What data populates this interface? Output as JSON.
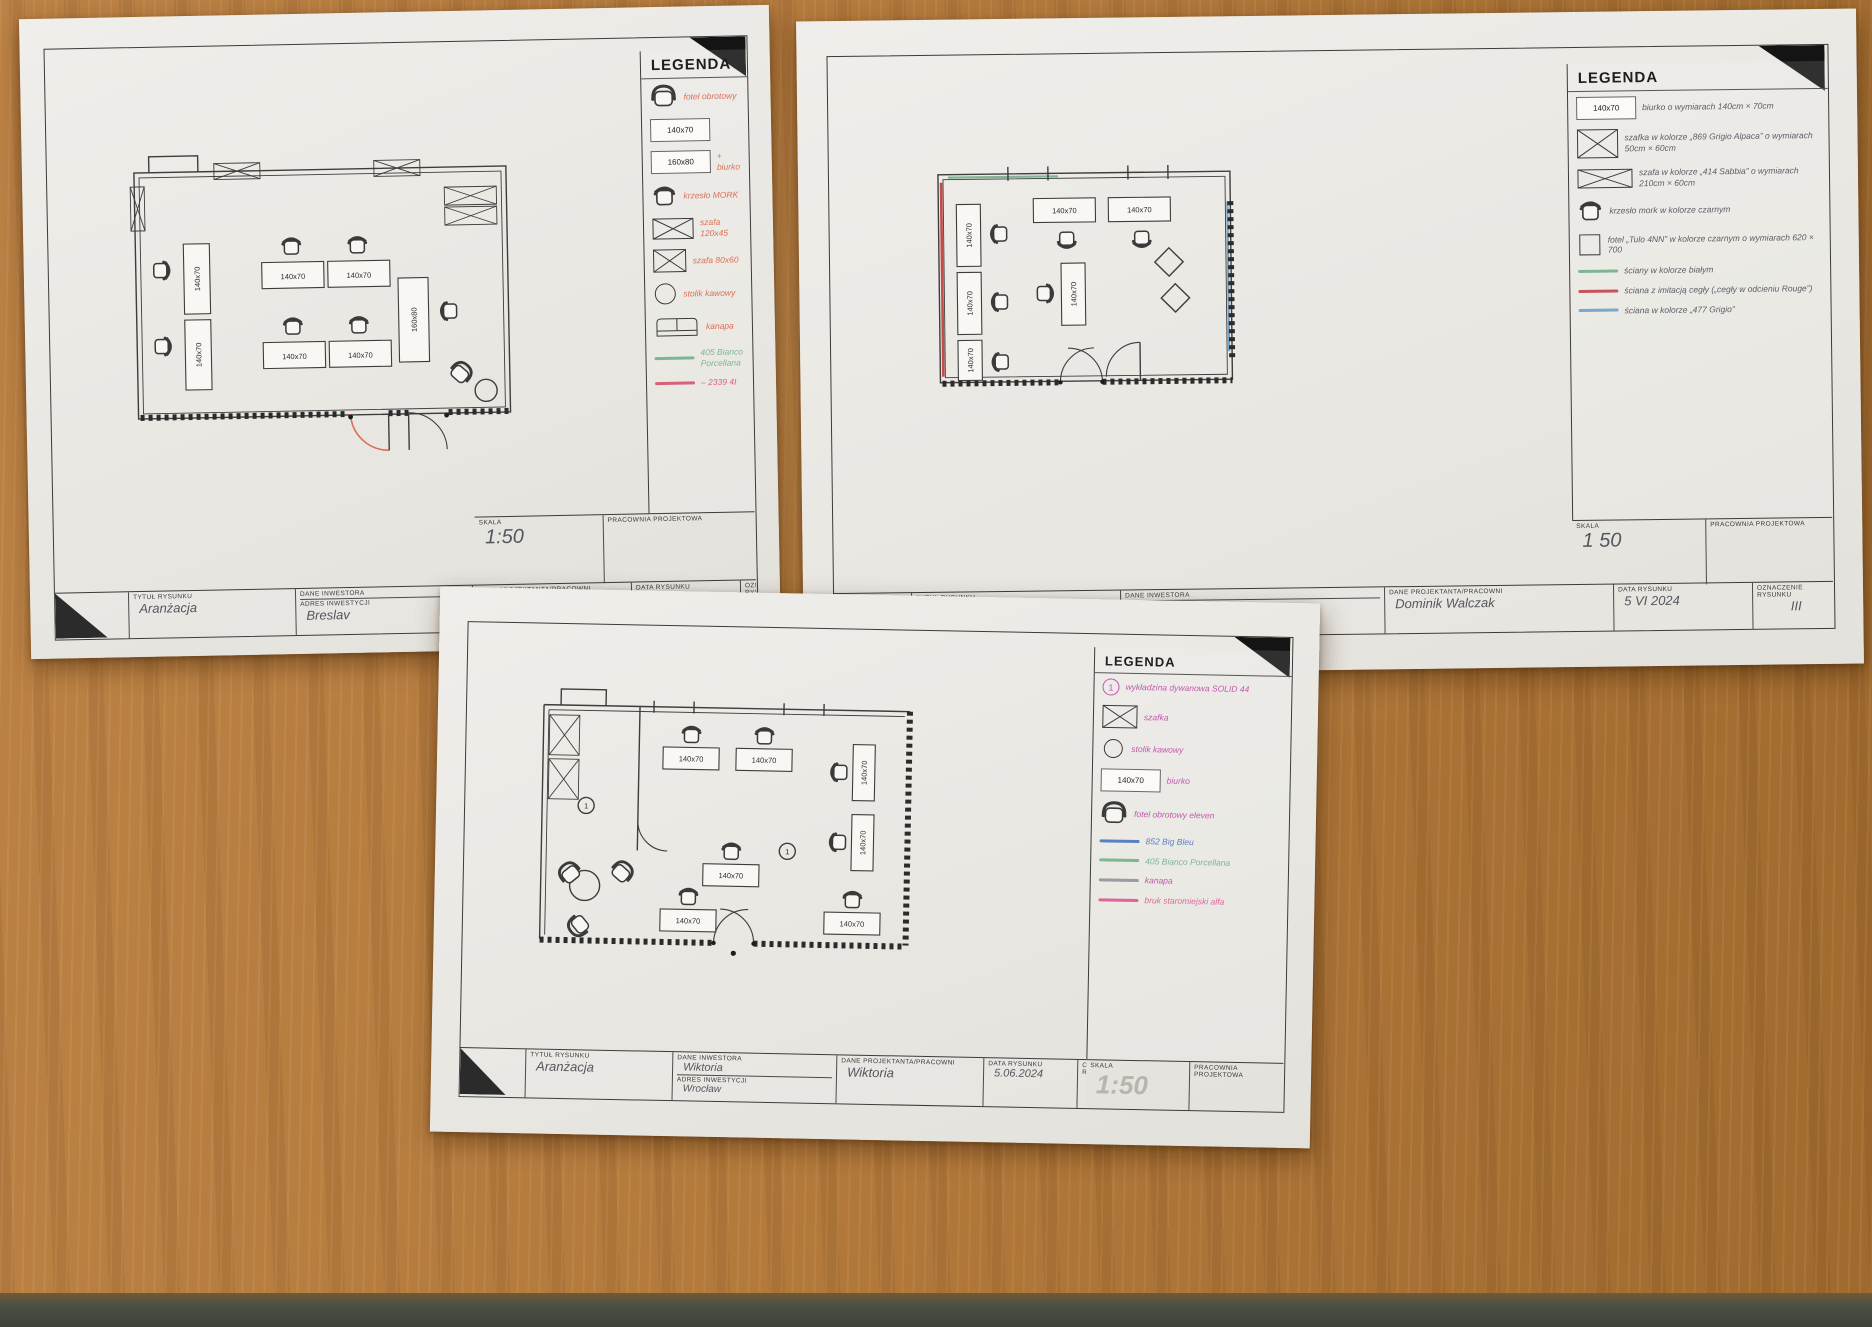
{
  "surface": {
    "description": "wooden desk top",
    "wood_color": "#b47a3c",
    "edge_color": "#4b4f45"
  },
  "sheets": [
    {
      "legend": {
        "title": "LEGENDA",
        "ink": "#dd6f55",
        "items": [
          {
            "icon": "armchair-top",
            "label": "fotel obrotowy"
          },
          {
            "icon": "desk-box",
            "value": "140x70"
          },
          {
            "icon": "desk-box",
            "value": "160x80",
            "note": "+ biurko"
          },
          {
            "icon": "chair-top",
            "label": "krzesło MORK"
          },
          {
            "icon": "crossed-box",
            "label": "szafa 120x45"
          },
          {
            "icon": "crossed-box",
            "label": "szafa 80x60"
          },
          {
            "icon": "circle",
            "label": "stolik kawowy"
          },
          {
            "icon": "sofa",
            "label": "kanapa"
          },
          {
            "icon": "color-line",
            "color": "#7eb694",
            "label": "405 Bianco Porcellana",
            "label_color": "#7eb694"
          },
          {
            "icon": "color-line",
            "color": "#d96079",
            "label": "– 2339 4I",
            "label_color": "#d96079"
          }
        ]
      },
      "title_block": {
        "skala_label": "SKALA",
        "skala_value": "1:50",
        "pracownia_label": "PRACOWNIA PROJEKTOWA",
        "tytul_label": "TYTUŁ RYSUNKU",
        "tytul_value": "Aranżacja",
        "inwestor_label": "DANE INWESTORA",
        "inwestor_value": "",
        "adres_label": "ADRES INWESTYCJI",
        "adres_value": "Breslav",
        "projektant_label": "DANE PROJEKTANTA/PRACOWNI",
        "projektant_value": "HANIA",
        "data_label": "DATA RYSUNKU",
        "data_value": "05.06.2024",
        "oznaczenie_label": "OZNACZENIE RYSUNKU",
        "oznaczenie_value": "nr 3"
      },
      "plan": {
        "desk_labels": [
          "140x70",
          "140x70",
          "140x70",
          "140x70",
          "140x70",
          "140x70",
          "160x80"
        ]
      }
    },
    {
      "legend": {
        "title": "LEGENDA",
        "ink": "#5c5c66",
        "items": [
          {
            "icon": "desk-box",
            "value": "140x70",
            "label": "biurko o wymiarach 140cm × 70cm"
          },
          {
            "icon": "crossed-box",
            "label": "szafka w kolorze „869 Grigio Alpaca” o wymiarach 50cm × 60cm"
          },
          {
            "icon": "crossed-box-wide",
            "label": "szafa w kolorze „414 Sabbia” o wymiarach 210cm × 60cm"
          },
          {
            "icon": "chair-top",
            "label": "krzesło mork w kolorze czarnym"
          },
          {
            "icon": "square",
            "label": "fotel „Tulo 4NN” w kolorze czarnym o wymiarach 620 × 700"
          },
          {
            "icon": "color-line",
            "color": "#7eb694",
            "label": "ściany w kolorze białym",
            "label_color": "#5c5c66"
          },
          {
            "icon": "color-line",
            "color": "#c9525e",
            "label": "ściana z imitacją cegły („cegły w odcieniu Rouge”)",
            "label_color": "#5c5c66"
          },
          {
            "icon": "color-line",
            "color": "#7aa7cb",
            "label": "ściana w kolorze „477 Grigio”",
            "label_color": "#5c5c66"
          }
        ]
      },
      "title_block": {
        "skala_label": "SKALA",
        "skala_value": "1 50",
        "pracownia_label": "PRACOWNIA PROJEKTOWA",
        "tytul_label": "TYTUŁ RYSUNKU",
        "tytul_value": "Aranżacja",
        "inwestor_label": "DANE INWESTORA",
        "inwestor_value": "",
        "adres_label": "ADRES INWESTYCJI",
        "adres_value": "ul. Średnia 2A-6 Szczecin",
        "projektant_label": "DANE PROJEKTANTA/PRACOWNI",
        "projektant_value": "Dominik Walczak",
        "data_label": "DATA RYSUNKU",
        "data_value": "5 VI 2024",
        "oznaczenie_label": "OZNACZENIE RYSUNKU",
        "oznaczenie_value": "III"
      },
      "plan": {
        "desk_labels": [
          "140x70",
          "140x70",
          "140x70",
          "140x70",
          "140x70",
          "140x70"
        ]
      }
    },
    {
      "legend": {
        "title": "LEGENDA",
        "ink": "#c257ae",
        "items": [
          {
            "icon": "circled-number",
            "number": "1",
            "label": "wykładzina dywanowa SOLID 44"
          },
          {
            "icon": "crossed-box",
            "label": "szafka"
          },
          {
            "icon": "circle",
            "label": "stolik kawowy"
          },
          {
            "icon": "desk-box",
            "value": "140x70",
            "label": "biurko"
          },
          {
            "icon": "armchair-top",
            "label": "fotel obrotowy eleven"
          },
          {
            "icon": "color-line",
            "color": "#5b7fc2",
            "label": "852 Big Bleu",
            "label_color": "#5b7fc2"
          },
          {
            "icon": "color-line",
            "color": "#7eb694",
            "label": "405 Bianco Porcellana",
            "label_color": "#7eb694"
          },
          {
            "icon": "color-line",
            "color": "#9a9aa0",
            "label": "kanapa",
            "label_color": "#c257ae"
          },
          {
            "icon": "color-line",
            "color": "#e0649c",
            "label": "bruk staromiejski alfa",
            "label_color": "#e0649c"
          }
        ]
      },
      "title_block": {
        "skala_label": "SKALA",
        "skala_value": "1:50",
        "pracownia_label": "PRACOWNIA PROJEKTOWA",
        "tytul_label": "TYTUŁ RYSUNKU",
        "tytul_value": "Aranżacja",
        "inwestor_label": "DANE INWESTORA",
        "inwestor_value": "Wiktoria",
        "adres_label": "ADRES INWESTYCJI",
        "adres_value": "Wrocław",
        "projektant_label": "DANE PROJEKTANTA/PRACOWNI",
        "projektant_value": "Wiktoria",
        "data_label": "DATA RYSUNKU",
        "data_value": "5.06.2024",
        "oznaczenie_label": "OZNACZENIE RYSUNKU",
        "oznaczenie_value": "rys nr 3"
      },
      "plan": {
        "desk_labels": [
          "140x70",
          "140x70",
          "140x70",
          "140x70",
          "140x70",
          "140x70",
          "140x70"
        ],
        "marker": "1"
      }
    }
  ]
}
